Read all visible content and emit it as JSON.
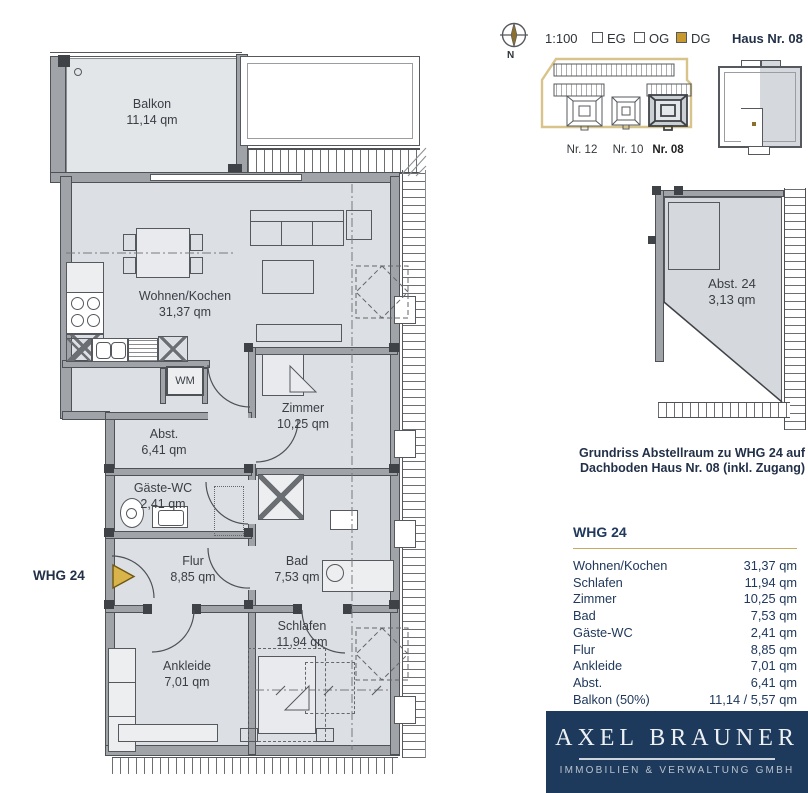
{
  "header": {
    "compass_n": "N",
    "scale": "1:100",
    "legend": [
      {
        "label": "EG",
        "checked": false
      },
      {
        "label": "OG",
        "checked": false
      },
      {
        "label": "DG",
        "checked": true
      }
    ],
    "house": "Haus Nr. 08"
  },
  "site_plan": {
    "houses": [
      {
        "label": "Nr. 12",
        "active": false
      },
      {
        "label": "Nr. 10",
        "active": false
      },
      {
        "label": "Nr. 08",
        "active": true
      }
    ]
  },
  "plan": {
    "unit_marker": "WHG 24",
    "appliance_label": "WM",
    "rooms": [
      {
        "name": "Balkon",
        "area": "11,14 qm"
      },
      {
        "name": "Wohnen/Kochen",
        "area": "31,37 qm"
      },
      {
        "name": "Zimmer",
        "area": "10,25 qm"
      },
      {
        "name": "Abst.",
        "area": "6,41 qm"
      },
      {
        "name": "Gäste-WC",
        "area": "2,41 qm"
      },
      {
        "name": "Flur",
        "area": "8,85 qm"
      },
      {
        "name": "Bad",
        "area": "7,53 qm"
      },
      {
        "name": "Schlafen",
        "area": "11,94 qm"
      },
      {
        "name": "Ankleide",
        "area": "7,01 qm"
      }
    ]
  },
  "storage_plan": {
    "name": "Abst. 24",
    "area": "3,13 qm",
    "caption_line1": "Grundriss Abstellraum zu WHG 24 auf",
    "caption_line2": "Dachboden Haus Nr. 08 (inkl. Zugang)"
  },
  "area_table": {
    "title": "WHG 24",
    "rows": [
      {
        "name": "Wohnen/Kochen",
        "value": "31,37 qm"
      },
      {
        "name": "Schlafen",
        "value": "11,94 qm"
      },
      {
        "name": "Zimmer",
        "value": "10,25 qm"
      },
      {
        "name": "Bad",
        "value": "7,53 qm"
      },
      {
        "name": "Gäste-WC",
        "value": "2,41 qm"
      },
      {
        "name": "Flur",
        "value": "8,85 qm"
      },
      {
        "name": "Ankleide",
        "value": "7,01 qm"
      },
      {
        "name": "Abst.",
        "value": "6,41 qm"
      },
      {
        "name": "Balkon (50%)",
        "value": "11,14 / 5,57 qm"
      }
    ]
  },
  "logo": {
    "name": "AXEL BRAUNER",
    "subtitle": "IMMOBILIEN & VERWALTUNG GMBH"
  },
  "colors": {
    "navy": "#1d3a5c",
    "gold_checkbox": "#c9992e",
    "gold_arrow": "#d9b44a",
    "tan_outline": "#d8c48a",
    "floor_fill": "#dcdfe3"
  }
}
